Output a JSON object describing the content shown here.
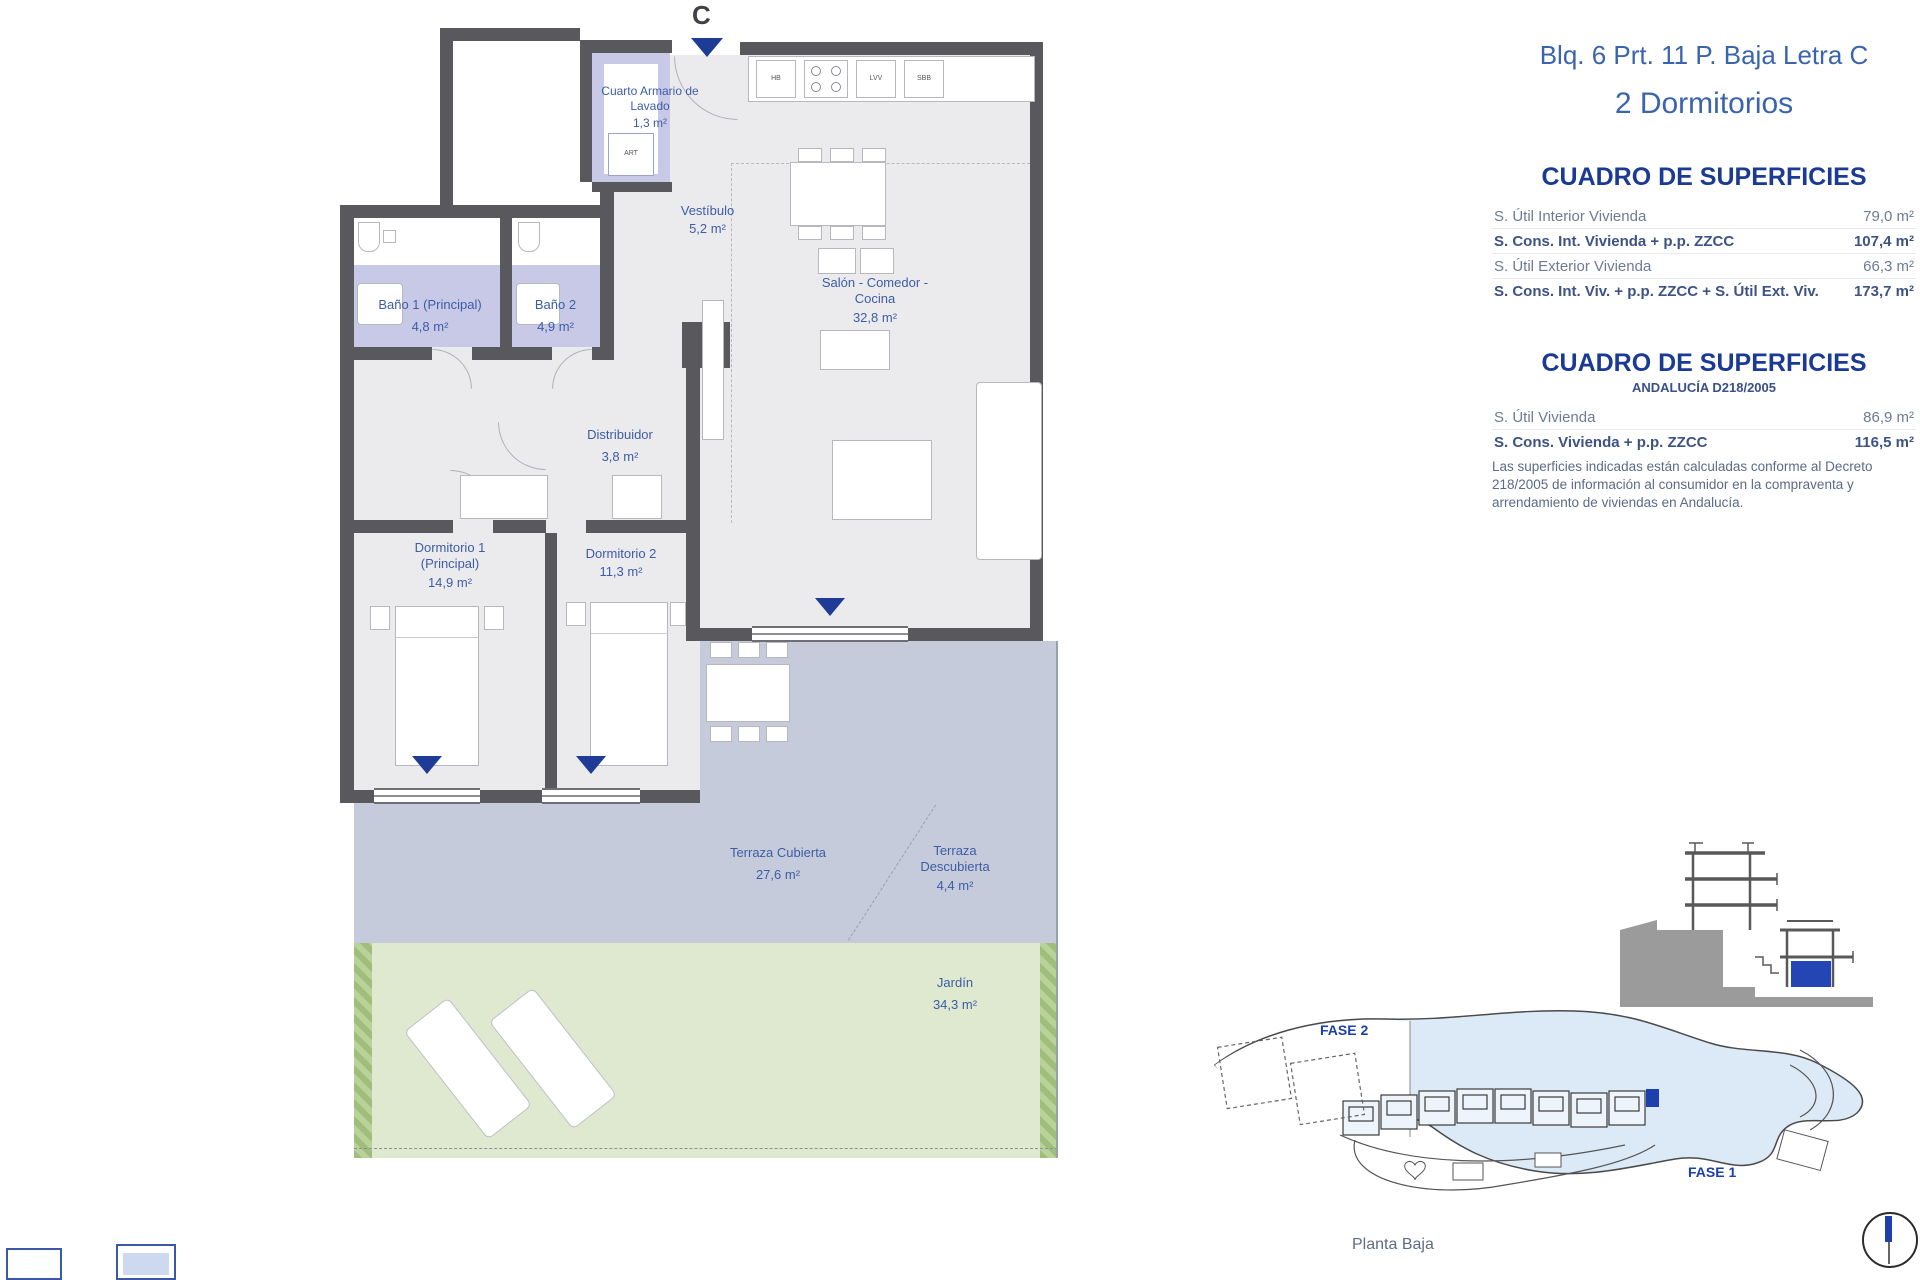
{
  "header": {
    "title": "Blq. 6 Prt. 11 P. Baja Letra C",
    "subtitle": "2 Dormitorios"
  },
  "tables": {
    "main": {
      "heading": "CUADRO DE SUPERFICIES",
      "rows": [
        {
          "label": "S. Útil Interior Vivienda",
          "value": "79,0 m²"
        },
        {
          "label": "S. Cons. Int. Vivienda + p.p. ZZCC",
          "value": "107,4 m²"
        },
        {
          "label": "S. Útil Exterior Vivienda",
          "value": "66,3 m²"
        },
        {
          "label": "S. Cons. Int. Viv. + p.p. ZZCC + S. Útil Ext. Viv.",
          "value": "173,7 m²"
        }
      ]
    },
    "andalucia": {
      "heading": "CUADRO DE SUPERFICIES",
      "subheading": "ANDALUCÍA D218/2005",
      "rows": [
        {
          "label": "S. Útil Vivienda",
          "value": "86,9 m²"
        },
        {
          "label": "S. Cons. Vivienda + p.p. ZZCC",
          "value": "116,5 m²"
        }
      ],
      "note": "Las superficies indicadas están calculadas conforme al Decreto 218/2005 de información al consumidor en la compraventa y arrendamiento de viviendas en Andalucía."
    }
  },
  "plan": {
    "block_letter": "C",
    "rooms": [
      {
        "name": "Cuarto Armario de Lavado",
        "area": "1,3 m²"
      },
      {
        "name": "Vestíbulo",
        "area": "5,2 m²"
      },
      {
        "name": "Salón - Comedor - Cocina",
        "area": "32,8 m²"
      },
      {
        "name": "Baño 1 (Principal)",
        "area": "4,8 m²"
      },
      {
        "name": "Baño 2",
        "area": "4,9 m²"
      },
      {
        "name": "Distribuidor",
        "area": "3,8 m²"
      },
      {
        "name": "Dormitorio 1 (Principal)",
        "area": "14,9 m²"
      },
      {
        "name": "Dormitorio 2",
        "area": "11,3 m²"
      },
      {
        "name": "Terraza Cubierta",
        "area": "27,6 m²"
      },
      {
        "name": "Terraza Descubierta",
        "area": "4,4 m²"
      },
      {
        "name": "Jardín",
        "area": "34,3 m²"
      }
    ],
    "appliances": {
      "hb": "HB",
      "lvv": "LVV",
      "sbb": "SBB",
      "washer": "ART"
    }
  },
  "site": {
    "fase2": "FASE 2",
    "fase1": "FASE 1",
    "caption": "Planta Baja"
  },
  "colors": {
    "accent_blue": "#1e3c96",
    "label_blue": "#3e5ca6",
    "wall_gray": "#59595d",
    "terrace": "#c5cbda",
    "garden": "#dee9d0",
    "bath": "#c7c9e6"
  }
}
